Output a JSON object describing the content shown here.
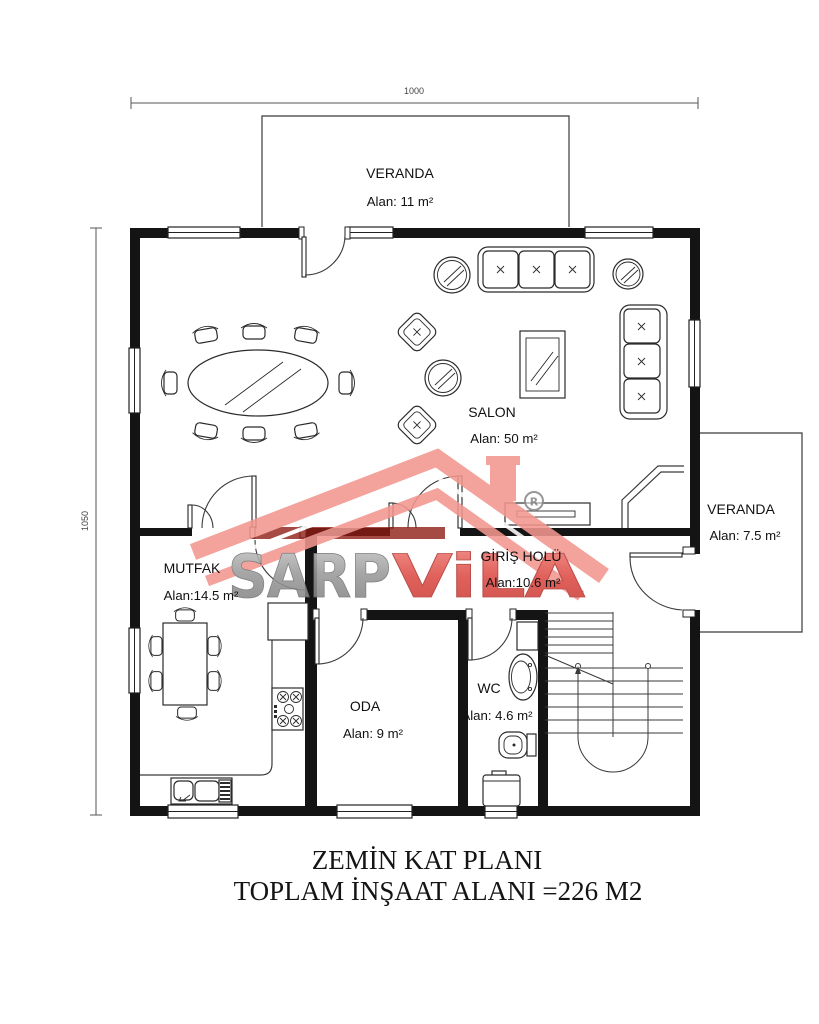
{
  "dimensions": {
    "width_label": "1000",
    "height_label": "1050"
  },
  "rooms": {
    "veranda_top": {
      "name": "VERANDA",
      "area": "Alan: 11 m²"
    },
    "salon": {
      "name": "SALON",
      "area": "Alan: 50 m²"
    },
    "veranda_right": {
      "name": "VERANDA",
      "area": "Alan: 7.5 m²"
    },
    "mutfak": {
      "name": "MUTFAK",
      "area": "Alan:14.5 m²"
    },
    "giris_holu": {
      "name": "GİRİŞ HOLÜ",
      "area": "Alan:10.6 m²"
    },
    "oda": {
      "name": "ODA",
      "area": "Alan: 9 m²"
    },
    "wc": {
      "name": "WC",
      "area": "Alan: 4.6 m²"
    }
  },
  "watermark": {
    "brand_gray": "SARP",
    "brand_red": "ViLA",
    "registered": "R",
    "colors": {
      "roof": "#f2968f",
      "roof_dark": "#8e1c12",
      "letters_gray": "#9a9a9a",
      "letters_red": "#dd4b45"
    }
  },
  "title": {
    "line1": "ZEMİN KAT PLANI",
    "line2": "TOPLAM İNŞAAT ALANI =226 M2"
  }
}
